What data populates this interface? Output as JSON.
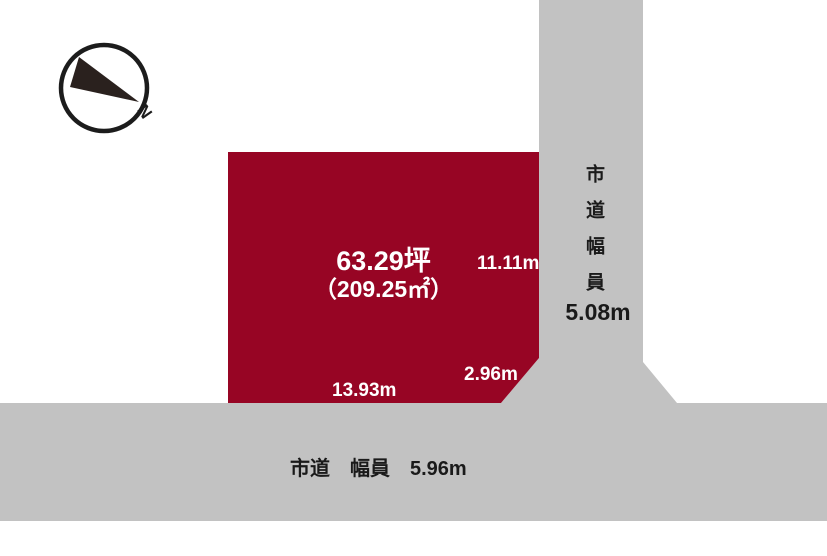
{
  "compass": {
    "north_label": "N"
  },
  "plot": {
    "area_tsubo": "63.29坪",
    "area_sqm": "（209.25㎡）",
    "dimensions": {
      "right": "11.11m",
      "corner": "2.96m",
      "bottom": "13.93m"
    }
  },
  "roads": {
    "right": {
      "name_vertical": "市道幅員",
      "width": "5.08m"
    },
    "bottom": {
      "label": "市道　幅員　5.96m"
    }
  },
  "colors": {
    "plot_fill": "#970524",
    "road_fill": "#c2c2c2",
    "plot_text": "#ffffff",
    "road_text": "#1a1a1a",
    "compass_stroke": "#1c1c1c",
    "compass_needle": "#2a211e"
  }
}
